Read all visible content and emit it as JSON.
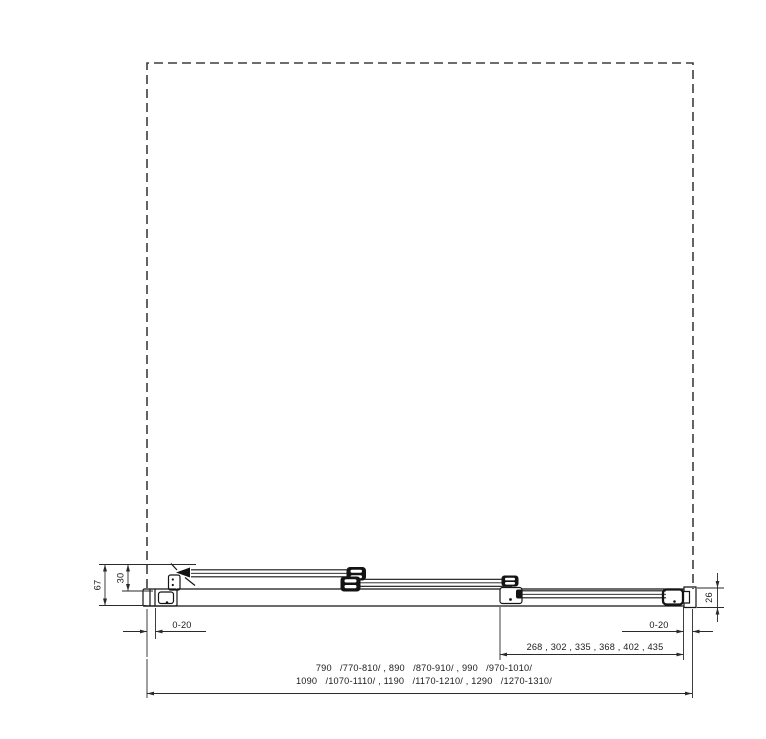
{
  "drawing": {
    "kind": "shower-sliding-door-technical-section",
    "dimensions": {
      "total_height": "67",
      "clamp_height": "30",
      "profile_height": "26",
      "wall_adjust_left": "0-20",
      "wall_adjust_right": "0-20",
      "panel_widths": "268 , 302 , 335 , 368 , 402 , 435",
      "overall_widths_line1": "790   /770-810/ , 890   /870-910/ , 990   /970-1010/",
      "overall_widths_line2": "1090   /1070-1110/ , 1190   /1170-1210/ , 1290   /1270-1310/"
    },
    "colors": {
      "line": "#151515",
      "dimension": "#2a2a2a",
      "dashed_outline": "#3d3d3d",
      "background": "#ffffff"
    }
  }
}
